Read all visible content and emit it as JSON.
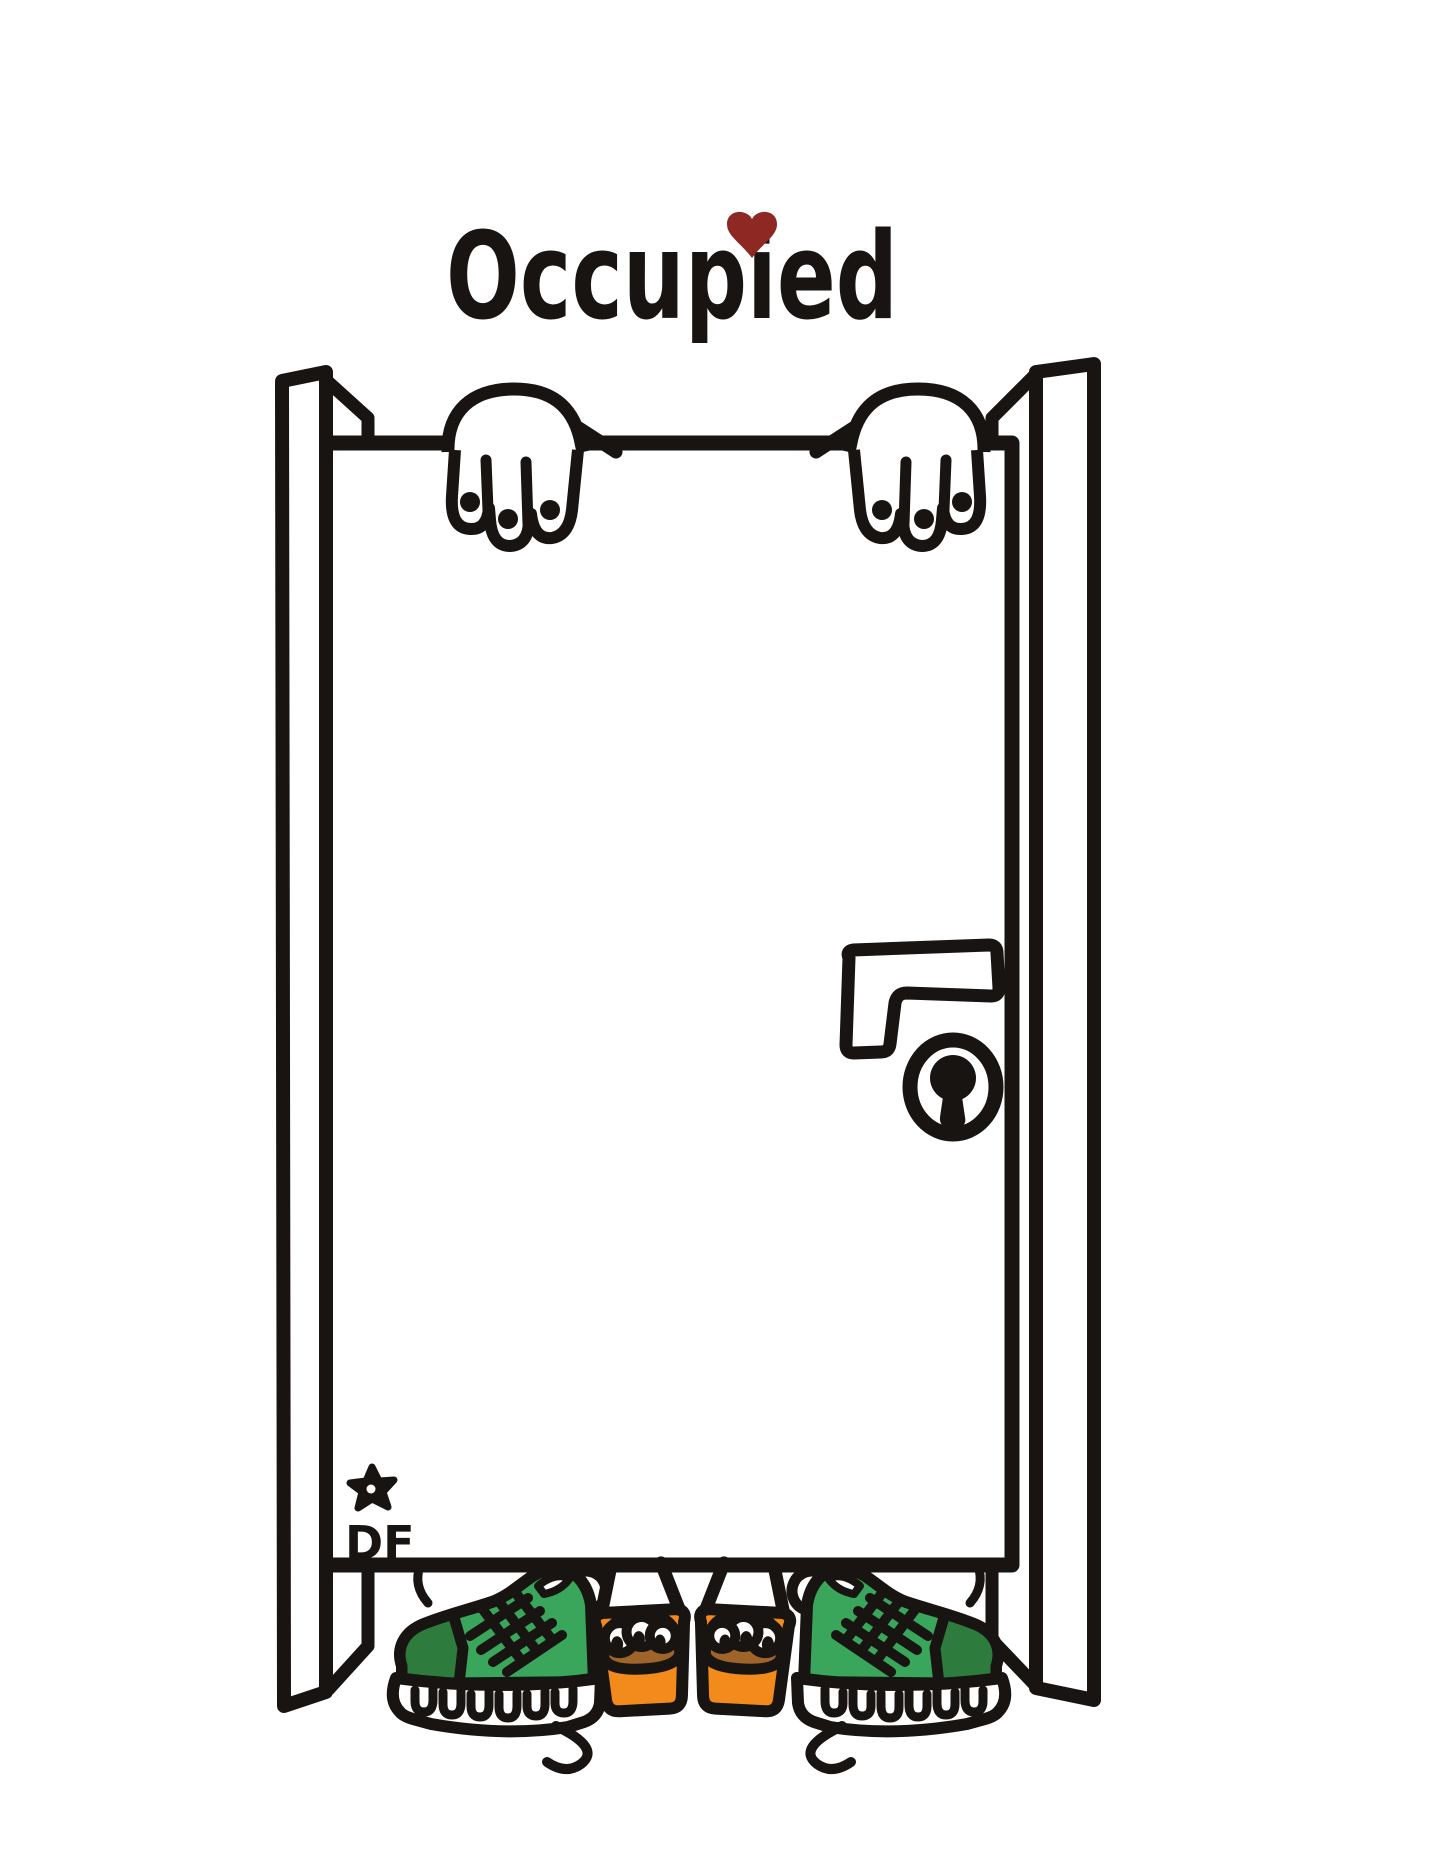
{
  "title": {
    "text": "Occupied",
    "dot_icon": "heart-icon"
  },
  "signature": {
    "initials": "DF",
    "mark_icon": "star-icon"
  },
  "scene_icons": {
    "door": "stall-door",
    "handle": "door-handle-icon",
    "lock": "keyhole-icon",
    "hands": "gripping-hands",
    "feet": "sneakers-and-sandals"
  },
  "colors": {
    "ink": "#181411",
    "paper": "#ffffff",
    "green": "#3aa65c",
    "green-dark": "#2e7b3e",
    "orange": "#f28b1c",
    "brown": "#9f642a",
    "heart-red": "#8e2823"
  }
}
